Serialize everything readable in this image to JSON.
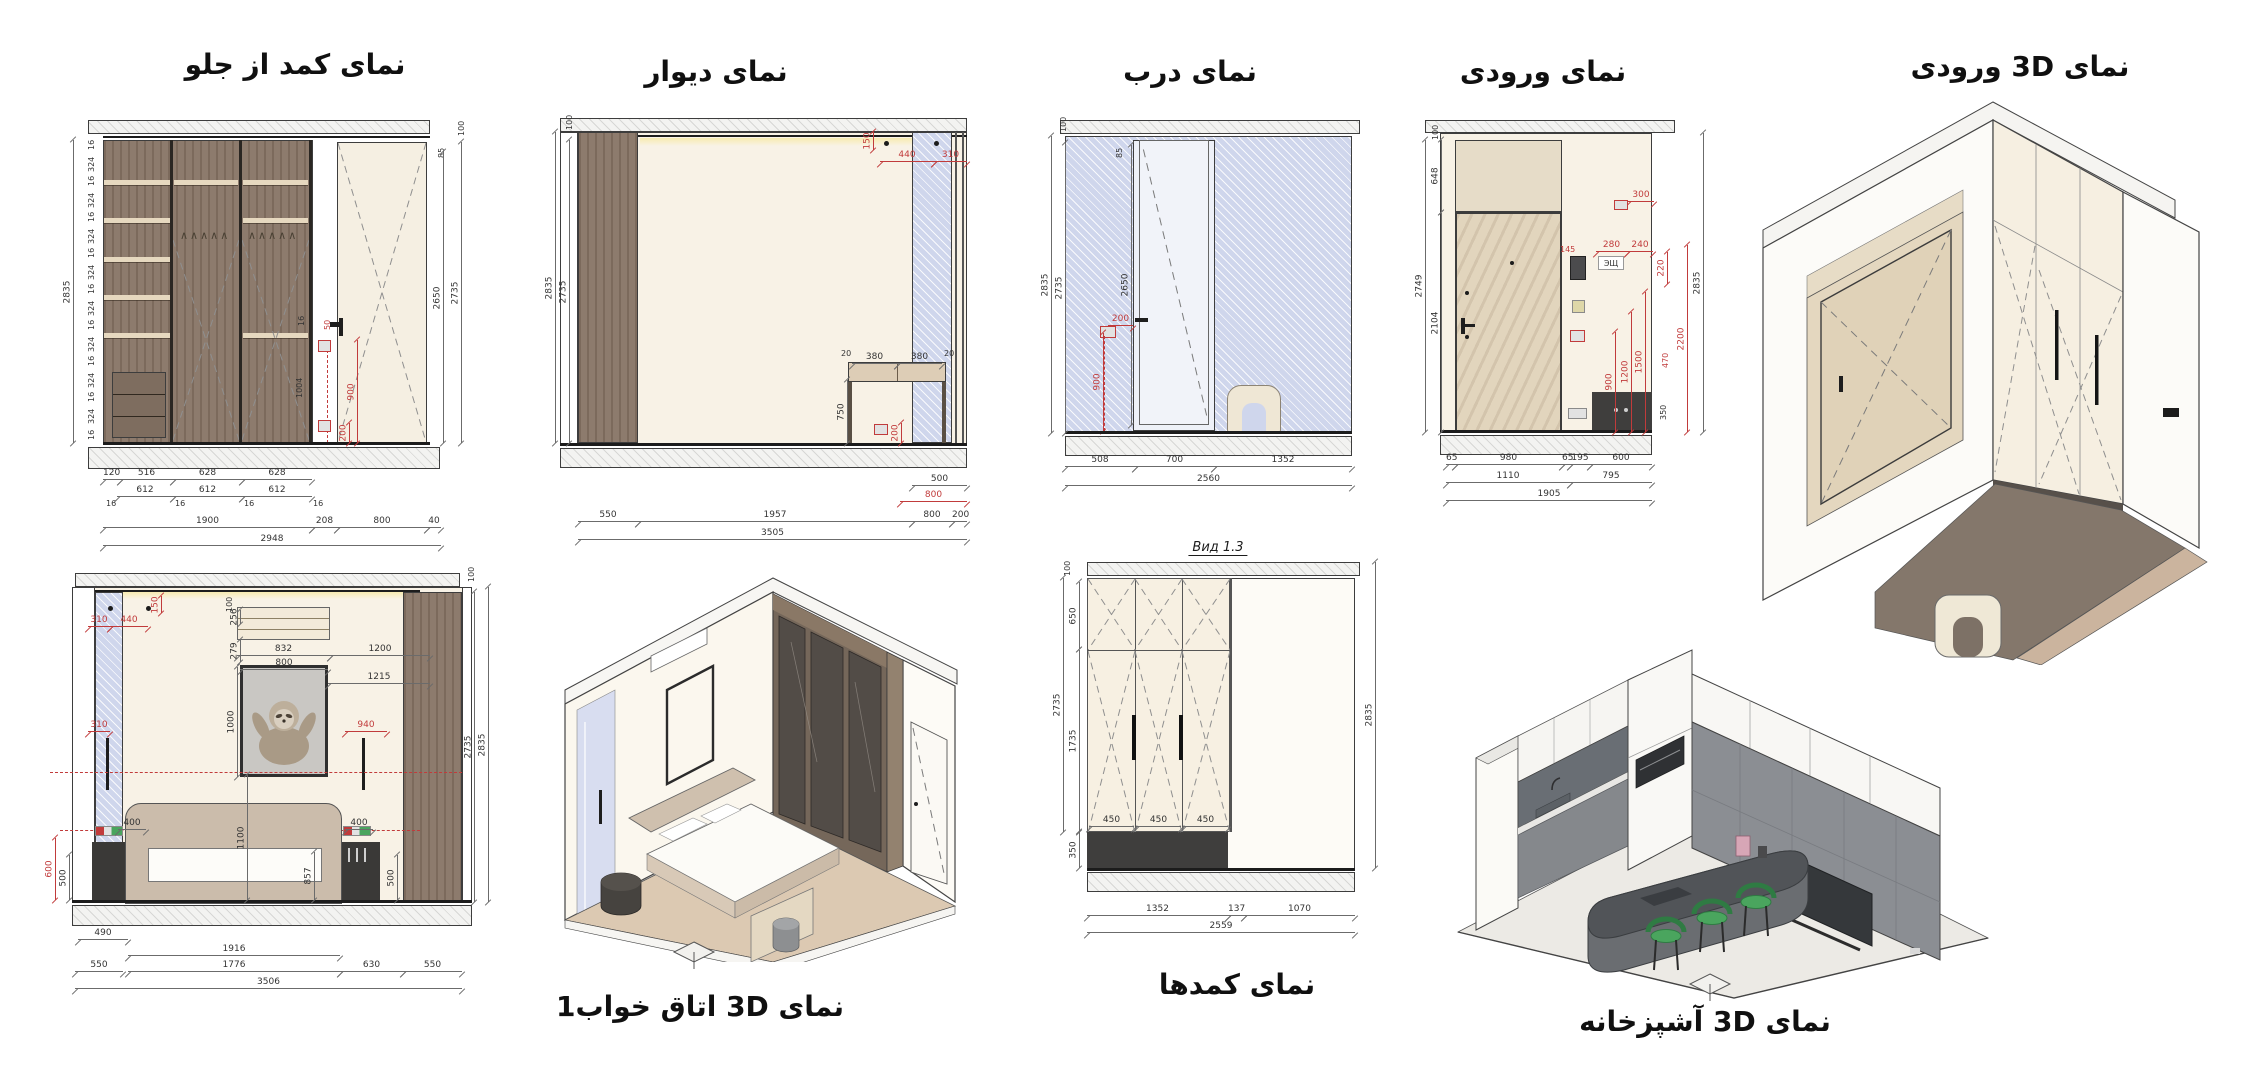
{
  "sheet_title": "interior-elevations-and-3d-views",
  "colors": {
    "dim_red": "#c13b3b",
    "wood_brown": "#8d7b6d",
    "wall_cream": "#f8f2e6",
    "hatch_blue": "#cfd6ec",
    "dark_base": "#3f3e3d",
    "chair_green": "#4aa55e"
  },
  "panels": {
    "closet_front": {
      "title": "نمای کمد از جلو"
    },
    "wall": {
      "title": "نمای دیوار"
    },
    "door": {
      "title": "نمای درب"
    },
    "entrance": {
      "title": "نمای ورودی"
    },
    "entrance_3d": {
      "title": "نمای 3D ورودی"
    },
    "bedroom_3d": {
      "title": "نمای 3D اتاق خواب1"
    },
    "closets": {
      "title": "نمای کمدها",
      "subtitle": "Вид 1.3"
    },
    "kitchen_3d": {
      "title": "نمای 3D آشپزخانه"
    }
  },
  "labels": {
    "esh": "ЭЩ",
    "hooks": "∧∧∧∧∧"
  },
  "dims": {
    "16": "16",
    "20": "20",
    "40": "40",
    "50": "50",
    "65": "65",
    "85": "85",
    "100": "100",
    "120": "120",
    "137": "137",
    "145": "145",
    "150": "150",
    "195": "195",
    "200": "200",
    "208": "208",
    "220": "220",
    "240": "240",
    "256": "256",
    "279": "279",
    "280": "280",
    "300": "300",
    "310": "310",
    "324": "324",
    "350": "350",
    "380": "380",
    "400": "400",
    "440": "440",
    "450": "450",
    "470": "470",
    "490": "490",
    "500": "500",
    "508": "508",
    "516": "516",
    "550": "550",
    "600": "600",
    "612": "612",
    "628": "628",
    "630": "630",
    "648": "648",
    "650": "650",
    "700": "700",
    "750": "750",
    "795": "795",
    "800": "800",
    "832": "832",
    "857": "857",
    "900": "900",
    "940": "940",
    "980": "980",
    "1000": "1000",
    "1004": "1004",
    "1070": "1070",
    "1100": "1100",
    "1110": "1110",
    "1200": "1200",
    "1215": "1215",
    "1352": "1352",
    "1500": "1500",
    "1735": "1735",
    "1776": "1776",
    "1900": "1900",
    "1905": "1905",
    "1916": "1916",
    "1957": "1957",
    "2104": "2104",
    "2200": "2200",
    "2560": "2560",
    "2559": "2559",
    "2650": "2650",
    "2735": "2735",
    "2749": "2749",
    "2835": "2835",
    "2948": "2948",
    "3505": "3505",
    "3506": "3506"
  }
}
